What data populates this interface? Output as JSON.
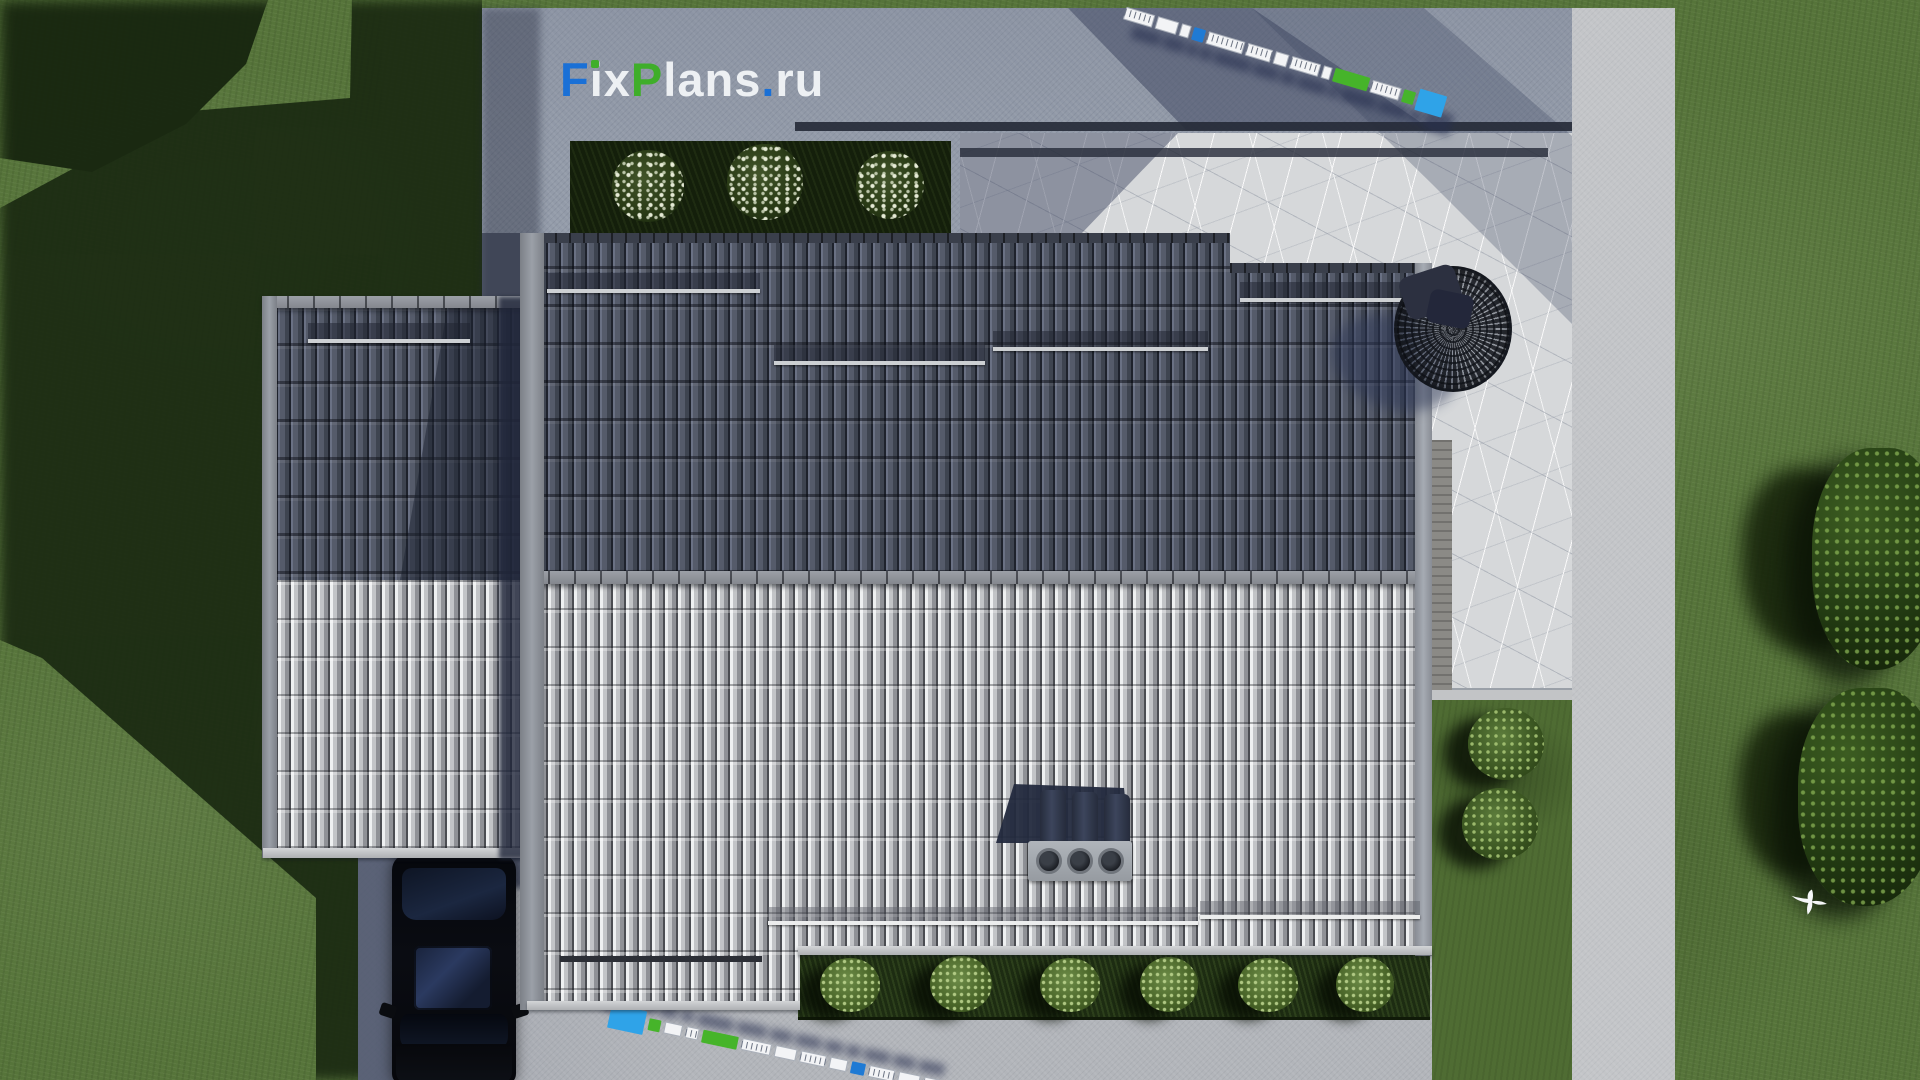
{
  "watermark": {
    "text": "FixPlans.ru",
    "parts": [
      {
        "text": "F",
        "color": "#1a70d6"
      },
      {
        "text": "i",
        "color": "#edf0f3"
      },
      {
        "text": "x",
        "color": "#edf0f3"
      },
      {
        "text": "P",
        "color": "#3fae2a"
      },
      {
        "text": "lans",
        "color": "#edf0f3"
      },
      {
        "text": ".",
        "color": "#1a70d6"
      },
      {
        "text": "ru",
        "color": "#edf0f3"
      }
    ],
    "i_dot_color": "#3fae2a"
  },
  "scene": {
    "type": "aerial-3d-architectural-render",
    "view": "top-down",
    "description": "Bird's-eye 3D rendering of a single-family house with a dual-pitch tiled gable roof (dark upper slope, light lower slope) and a matching left annex wing, set on a concrete apron with a cracked-stone patio, white-flowering front bed, rear hedge with shrubs, black car on the driveway, round woven hanging chair, two decorative measuring-tape scale bars, lawn with cast shadows, edge trees and a white flying bird.",
    "palette": {
      "grass": "#56743a",
      "grass_shadow": "#1b2a12",
      "concrete": "#939ba9",
      "concrete_light": "#c3c5c8",
      "stone_patio": "#d6d8da",
      "roof_dark_tiles": "#4e5360",
      "roof_light_tiles": "#b2b4b8",
      "ridge_trim": "#90939a",
      "hedge": "#141f0b",
      "car": "#07080c",
      "tape_white": "#f3f4f6",
      "tape_blue": "#1f7ad4",
      "tape_cyan": "#2fa3e8",
      "tape_green": "#46b42a"
    },
    "elements": {
      "house": {
        "upper_slope": "dark gray tiles",
        "lower_slope": "light gray tiles",
        "annex": "left wing gable roof",
        "snow_guard_rails": 8,
        "chimney_vents": 3
      },
      "flower_bed": {
        "bush_count": 3,
        "flower_color": "white"
      },
      "rear_hedge": {
        "bush_count": 6
      },
      "pocket_garden": {
        "bush_count": 2
      },
      "measuring_tapes": {
        "count": 2,
        "segment_colors": [
          "white",
          "blue",
          "green",
          "cyan"
        ]
      },
      "car": {
        "color": "black",
        "location": "driveway bottom-left"
      },
      "hanging_chair": {
        "style": "round woven mesh",
        "location": "stone patio right of house"
      },
      "trees": {
        "right_edge_clusters": 2
      },
      "bird": {
        "color": "white",
        "state": "flying"
      }
    }
  },
  "tapes": {
    "top": {
      "angle_deg": 16.5,
      "segments": [
        {
          "w": 30,
          "h": 13,
          "c": "ruler"
        },
        {
          "w": 22,
          "h": 13,
          "c": "white"
        },
        {
          "w": 10,
          "h": 13,
          "c": "white"
        },
        {
          "w": 12,
          "h": 13,
          "c": "blue"
        },
        {
          "w": 38,
          "h": 13,
          "c": "ruler"
        },
        {
          "w": 26,
          "h": 13,
          "c": "ruler"
        },
        {
          "w": 14,
          "h": 13,
          "c": "white"
        },
        {
          "w": 30,
          "h": 13,
          "c": "ruler"
        },
        {
          "w": 9,
          "h": 13,
          "c": "white"
        },
        {
          "w": 36,
          "h": 14,
          "c": "green"
        },
        {
          "w": 30,
          "h": 13,
          "c": "ruler"
        },
        {
          "w": 12,
          "h": 13,
          "c": "green"
        },
        {
          "w": 28,
          "h": 22,
          "c": "cyan"
        }
      ]
    },
    "bottom": {
      "angle_deg": 12,
      "segments": [
        {
          "w": 36,
          "h": 24,
          "c": "cyan"
        },
        {
          "w": 12,
          "h": 12,
          "c": "green"
        },
        {
          "w": 18,
          "h": 12,
          "c": "white"
        },
        {
          "w": 13,
          "h": 12,
          "c": "ruler"
        },
        {
          "w": 36,
          "h": 13,
          "c": "green"
        },
        {
          "w": 30,
          "h": 12,
          "c": "ruler"
        },
        {
          "w": 22,
          "h": 12,
          "c": "white"
        },
        {
          "w": 26,
          "h": 12,
          "c": "ruler"
        },
        {
          "w": 18,
          "h": 12,
          "c": "white"
        },
        {
          "w": 14,
          "h": 12,
          "c": "blue"
        },
        {
          "w": 26,
          "h": 12,
          "c": "ruler"
        },
        {
          "w": 22,
          "h": 12,
          "c": "white"
        },
        {
          "w": 26,
          "h": 12,
          "c": "ruler"
        }
      ]
    }
  }
}
